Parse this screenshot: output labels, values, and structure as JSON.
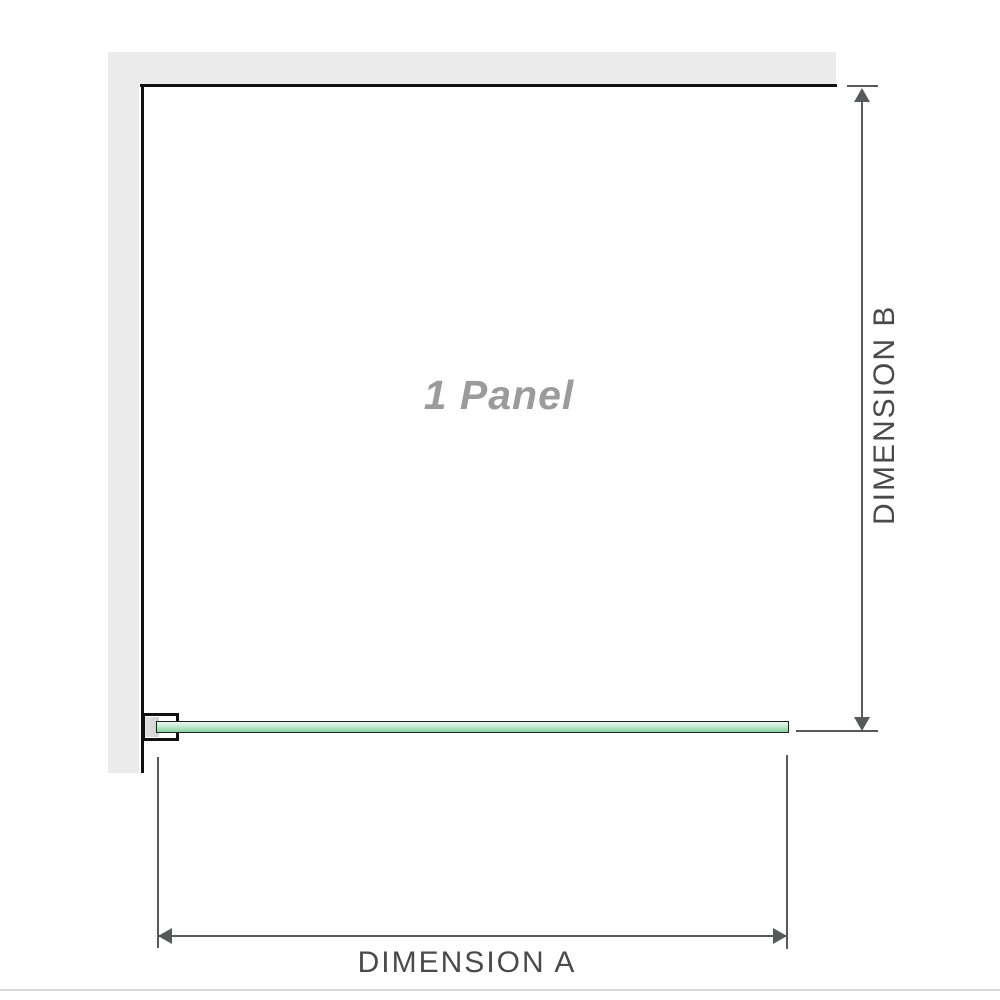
{
  "diagram": {
    "title_watermark": "1 Panel",
    "dimension_a": {
      "label": "DIMENSION A",
      "orientation": "horizontal"
    },
    "dimension_b": {
      "label": "DIMENSION B",
      "orientation": "vertical"
    },
    "components": {
      "wall": "l-shaped-wall",
      "glass_panel": "single-glass-panel-top-view",
      "bracket": "wall-mount-clamp"
    },
    "colors": {
      "wall_fill": "#ebebeb",
      "wall_line": "#111111",
      "glass_fill_light": "#e9f7ed",
      "glass_fill_dark": "#8fd2a3",
      "glass_border": "#1d241f",
      "dimension_line": "#58595b",
      "dimension_text": "#4a4a4b",
      "watermark_text": "#9b9b9b",
      "separator": "#d9d9d9",
      "bracket_pad": "#d5d5d5"
    }
  }
}
